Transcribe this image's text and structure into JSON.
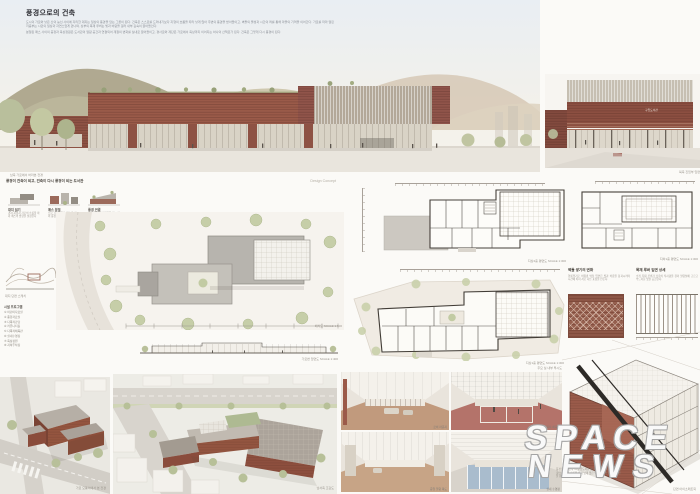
{
  "title_block": {
    "title": "풍경으로의 건축",
    "para1": "도시의 가로와 낮은 산의 능선 사이에 자리한 대지는 일상의 풍경을 담는 그릇이 된다. 건축은 스스로를 드러내기보다 지형의 흐름을 따라 낮게 앉아 주변의 풍경을 받아들이고, 벽돌의 물성과 시간의 켜를 통해 마을의 기억을 이어간다. 가로를 따라 열린 저층부는 시민의 일상과 자연스럽게 만나며, 상부의 목재 루버는 빛과 바람을 걸러 내부 깊숙이 끌어들인다.",
    "para2": "분절된 매스 사이의 중정과 옥상정원은 도서관의 열람 공간과 연결되어 계절의 변화를 실내로 끌어들이고, 경사로와 계단은 가로에서 옥상까지 이어지는 하나의 산책로가 된다. 건축은 그렇게 다시 풍경이 된다."
  },
  "hero": {
    "caption": "남측 가로에서 바라본 전경"
  },
  "elevation": {
    "caption": "북측 진입부 입면",
    "sign": "구립도서관"
  },
  "concept": {
    "header": "풍경이 건축이 되고, 건축이 다시 풍경이 되는 도서관",
    "header_right": "Design Concept",
    "diagrams": [
      {
        "label": "대지 읽기",
        "desc": "경사 지형과 가로의 흐름을 따라 매스의 방향을 설정한다"
      },
      {
        "label": "매스 분절",
        "desc": "프로그램 단위로 매스를 나누어 중정과 틈을 형성한다"
      },
      {
        "label": "풍경 연결",
        "desc": "가로-중정-옥상정원을 잇는 경사 산책로를 계획한다"
      }
    ],
    "sketch_caption": "대지 단면 스케치",
    "program_title": "시설 프로그램",
    "program_items": [
      "① 어린이자료실",
      "② 종합자료실",
      "③ 다목적강당",
      "④ 커뮤니티홀",
      "⑤ 다목적체육관",
      "⑥ 실내수영장",
      "⑦ 옥상정원",
      "⑧ 지하주차장"
    ]
  },
  "site_plan": {
    "caption": "배치도 SCALE 1:500",
    "section_caption": "가로변 입면도 SCALE 1:400"
  },
  "plans": [
    {
      "caption": "지상2층 평면도 SCALE 1:300"
    },
    {
      "caption": "지상1층 평면도 SCALE 1:300"
    },
    {
      "caption": "지하1층 평면도 SCALE 1:300"
    }
  ],
  "details": [
    {
      "title": "벽돌 쌓기의 변화",
      "desc": "영롱쌓기로 비워낸 벽돌 입면은 빛과 바람을 통과시키며 시간에 따라 서로 다른 표정을 만든다."
    },
    {
      "title": "목재 루버 입면 상세",
      "desc": "수직 목재 루버가 남측의 직사광을 걸러 열람실에 고르고 부드러운 빛을 공급한다."
    }
  ],
  "axon": {
    "caption": "단면 아이소메트릭"
  },
  "aerials": [
    {
      "caption": "가로 모퉁이에서 본 전경"
    },
    {
      "caption": "남서측 조감도"
    }
  ],
  "interiors": {
    "header": "주요 실 내부 투시도",
    "items": [
      {
        "caption": "로비 라운지"
      },
      {
        "caption": "다목적 체육관"
      },
      {
        "caption": "중앙 열람 복도"
      },
      {
        "caption": "실내 수영장"
      }
    ]
  },
  "watermark": {
    "line1": "SPACE",
    "line2": "NEWS"
  },
  "footnote": "풍경으로의 건축 — 구립도서관 및 생활체육시설 설계공모 제출안. 대지의 흐름을 따라 낮게 앉은 벽돌 매스가 가로의 풍경을 완성한다."
}
